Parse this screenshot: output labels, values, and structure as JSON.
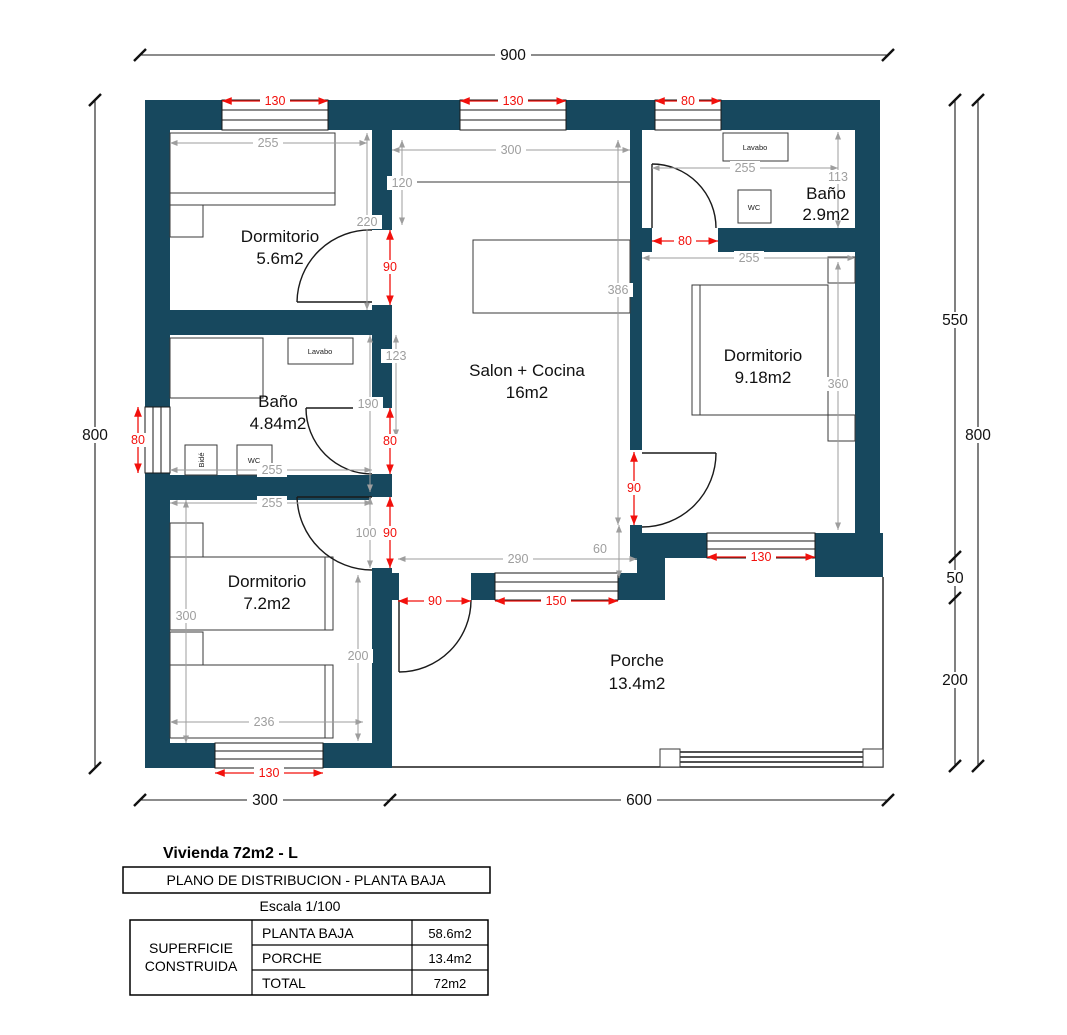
{
  "rooms": {
    "dorm1": {
      "name": "Dormitorio",
      "area": "5.6m2"
    },
    "bano1": {
      "name": "Baño",
      "area": "4.84m2"
    },
    "dorm2": {
      "name": "Dormitorio",
      "area": "7.2m2"
    },
    "salon": {
      "name": "Salon + Cocina",
      "area": "16m2"
    },
    "bano2": {
      "name": "Baño",
      "area": "2.9m2"
    },
    "dorm3": {
      "name": "Dormitorio",
      "area": "9.18m2"
    },
    "porche": {
      "name": "Porche",
      "area": "13.4m2"
    }
  },
  "fixtures": {
    "lavabo1": "Lavabo",
    "wc1": "WC",
    "bide": "Bidé",
    "lavabo2": "Lavabo",
    "wc2": "WC"
  },
  "dims": {
    "overall": {
      "top": "900",
      "left": "800",
      "right_upper": "550",
      "right_mid": "50",
      "right_lower": "200",
      "right_outer": "800",
      "bottom_left": "300",
      "bottom_right": "600"
    },
    "red": {
      "win_dorm1": "130",
      "win_salon": "130",
      "win_bano2": "80",
      "win_bano1": "80",
      "door_dorm1": "90",
      "door_bano1": "80",
      "door_dorm2": "90",
      "door_bano2": "80",
      "door_dorm3": "90",
      "win_dorm3": "130",
      "door_entry": "90",
      "win_salon_south": "150",
      "win_dorm2": "130"
    },
    "gray": {
      "dorm1_width": "255",
      "dorm1_height": "220",
      "salon_width": "300",
      "kitchen_depth": "120",
      "salon_height": "386",
      "salon_door_span": "290",
      "step": "60",
      "bano1_upper": "123",
      "bano1_lower": "190",
      "bano1_width": "255",
      "dorm2_width": "255",
      "dorm2_height": "300",
      "dorm2_bed": "236",
      "dorm2_right": "200",
      "dorm2_door_off": "100",
      "bano2_width": "255",
      "bano2_height": "113",
      "dorm3_width": "255",
      "dorm3_height": "360"
    }
  },
  "title_block": {
    "title": "Vivienda 72m2 - L",
    "subtitle": "PLANO DE DISTRIBUCION - PLANTA BAJA",
    "scale": "Escala 1/100",
    "table": {
      "header_line1": "SUPERFICIE",
      "header_line2": "CONSTRUIDA",
      "rows": [
        {
          "label": "PLANTA BAJA",
          "value": "58.6m2"
        },
        {
          "label": "PORCHE",
          "value": "13.4m2"
        },
        {
          "label": "TOTAL",
          "value": "72m2"
        }
      ]
    }
  },
  "colors": {
    "wall": "#17485e",
    "dim_red": "#f2100c",
    "dim_gray": "#9e9e9e",
    "line_black": "#1a1a1a"
  }
}
